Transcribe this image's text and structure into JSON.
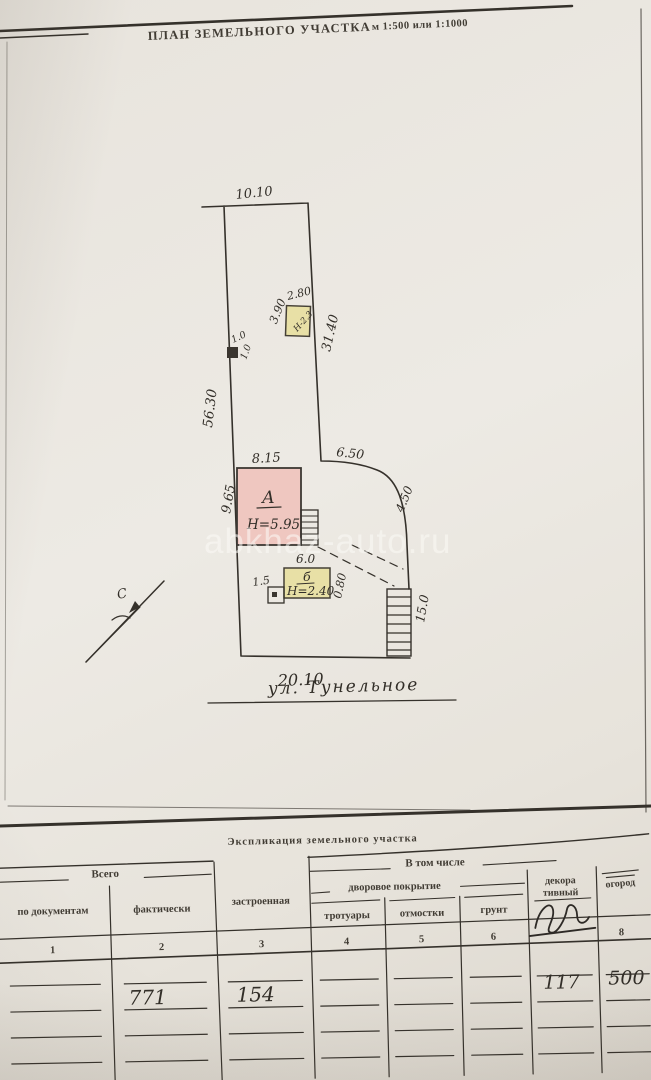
{
  "document": {
    "title": "ПЛАН ЗЕМЕЛЬНОГО УЧАСТКА",
    "scale": "м 1:500 или 1:1000",
    "watermark": "abkhaz-auto.ru"
  },
  "plan": {
    "north_label": "С",
    "street_name": "ул. Тунельное",
    "dims": {
      "top_width": "10.10",
      "left_side": "56.30",
      "right_side": "31.40",
      "east_segment": "6.50",
      "east_slope": "4.50",
      "bottom_width": "20.10",
      "stairs_length": "15.0",
      "gate_width": "1.0",
      "gate_depth": "1.0"
    },
    "building_a": {
      "width": "8.15",
      "depth": "9.65",
      "label": "А",
      "height": "Н=5.95"
    },
    "building_b": {
      "width": "6.0",
      "label": "б",
      "height": "Н=2.40",
      "annex_width": "1.5",
      "offset": "0.80"
    },
    "shed": {
      "width": "2.80",
      "depth": "3.90",
      "height": "Н-2.3"
    }
  },
  "table": {
    "title": "Экспликация земельного участка",
    "group_total": "Всего",
    "group_including": "В том числе",
    "group_yard": "дворовое покрытие",
    "columns": [
      {
        "label": "по документам",
        "num": "1",
        "value": ""
      },
      {
        "label": "фактически",
        "num": "2",
        "value": "771"
      },
      {
        "label": "застроенная",
        "num": "3",
        "value": "154"
      },
      {
        "label": "тротуары",
        "num": "4",
        "value": ""
      },
      {
        "label": "отмостки",
        "num": "5",
        "value": ""
      },
      {
        "label": "грунт",
        "num": "6",
        "value": ""
      },
      {
        "label_line1": "декора",
        "label_line2": "тивный",
        "num": "",
        "value": "117"
      },
      {
        "label": "огород",
        "num": "8",
        "value": "500"
      }
    ]
  }
}
